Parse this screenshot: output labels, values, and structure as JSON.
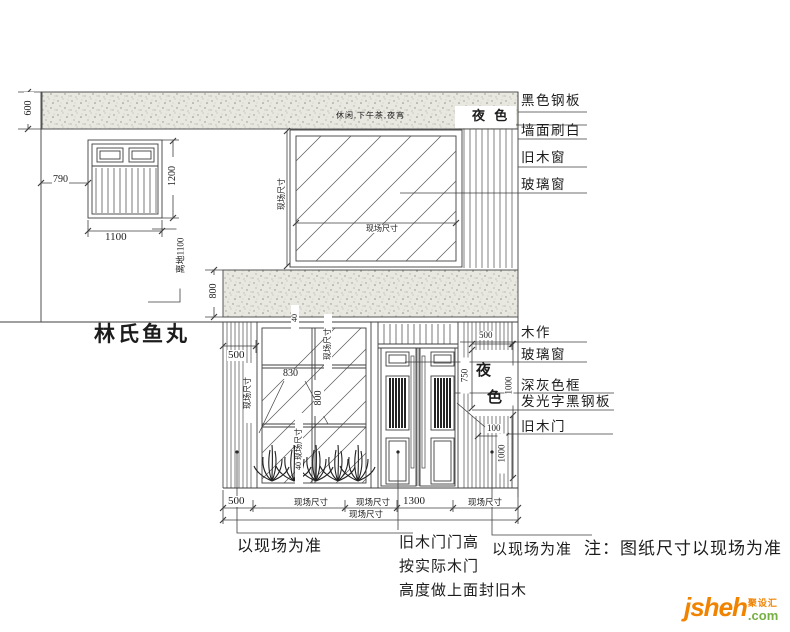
{
  "colors": {
    "line": "#3f3f3f",
    "band_fill": "#e8e8e1",
    "band_speckle": "#97978c",
    "logo_orange": "#f08300",
    "logo_green": "#76b043"
  },
  "shop_name": "林氏鱼丸",
  "banner_small_text": "休闲,下午茶,夜宵",
  "night_sign_horizontal": "夜 色",
  "night_sign_vertical": {
    "char1": "夜",
    "char2": "色"
  },
  "labels_top": [
    "黑色钢板",
    "墙面刷白",
    "旧木窗",
    "玻璃窗"
  ],
  "labels_mid": [
    "木作",
    "玻璃窗",
    "深灰色框",
    "发光字黑钢板",
    "旧木门"
  ],
  "dims": {
    "d600": "600",
    "d790": "790",
    "d1100": "1100",
    "d1200": "1200",
    "above_ground": "离地1100",
    "d800_band": "800",
    "site": "现场尺寸",
    "d500": "500",
    "d830": "830",
    "d800": "800",
    "d40": "40",
    "d40_site": "40 现场尺寸",
    "d750": "750",
    "d1000": "1000",
    "d100": "100",
    "d1300": "1300"
  },
  "notes": {
    "as_site": "以现场为准",
    "door": "旧木门门高\n按实际木门\n高度做上面封旧木",
    "main": "注：图纸尺寸以现场为准"
  },
  "logo": {
    "name": "jsheh",
    "tld": ".com",
    "cn": "聚设汇"
  }
}
